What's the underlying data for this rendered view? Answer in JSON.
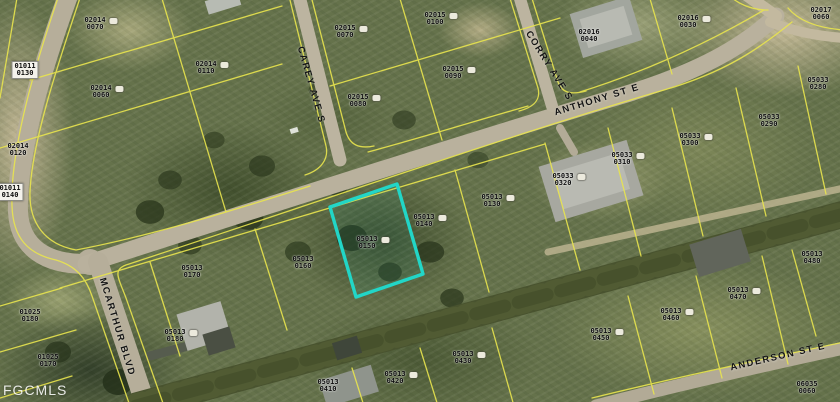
{
  "map": {
    "watermark": "FGCMLS",
    "highlighted_parcel": {
      "block": "05013",
      "lot": "0150",
      "outline_color": "#22d6c7"
    },
    "parcel_line_color": "#e9e54e",
    "streets": [
      {
        "name": "CAREY AVE S",
        "x": 311,
        "y": 85,
        "rotate": 74
      },
      {
        "name": "CORRY AVE S",
        "x": 549,
        "y": 66,
        "rotate": 58
      },
      {
        "name": "ANTHONY ST E",
        "x": 597,
        "y": 100,
        "rotate": -17
      },
      {
        "name": "MCARTHUR BLVD",
        "x": 117,
        "y": 327,
        "rotate": 73
      },
      {
        "name": "ANDERSON ST E",
        "x": 778,
        "y": 357,
        "rotate": -13
      }
    ],
    "parcels": [
      {
        "block": "02014",
        "lot": "0070",
        "x": 95,
        "y": 24,
        "chip": false,
        "icon": true,
        "highlighted": false
      },
      {
        "block": "01011",
        "lot": "0130",
        "x": 25,
        "y": 70,
        "chip": true,
        "icon": false,
        "highlighted": false
      },
      {
        "block": "02014",
        "lot": "0110",
        "x": 206,
        "y": 68,
        "chip": false,
        "icon": true,
        "highlighted": false
      },
      {
        "block": "02014",
        "lot": "0060",
        "x": 101,
        "y": 92,
        "chip": false,
        "icon": true,
        "highlighted": false
      },
      {
        "block": "02014",
        "lot": "0120",
        "x": 18,
        "y": 150,
        "chip": false,
        "icon": false,
        "highlighted": false
      },
      {
        "block": "01011",
        "lot": "0140",
        "x": 10,
        "y": 192,
        "chip": true,
        "icon": false,
        "highlighted": false
      },
      {
        "block": "02015",
        "lot": "0070",
        "x": 345,
        "y": 32,
        "chip": false,
        "icon": true,
        "highlighted": false
      },
      {
        "block": "02015",
        "lot": "0100",
        "x": 435,
        "y": 19,
        "chip": false,
        "icon": true,
        "highlighted": false
      },
      {
        "block": "02015",
        "lot": "0090",
        "x": 453,
        "y": 73,
        "chip": false,
        "icon": true,
        "highlighted": false
      },
      {
        "block": "02015",
        "lot": "0080",
        "x": 358,
        "y": 101,
        "chip": false,
        "icon": true,
        "highlighted": false
      },
      {
        "block": "02016",
        "lot": "0040",
        "x": 589,
        "y": 36,
        "chip": false,
        "icon": false,
        "highlighted": false
      },
      {
        "block": "02016",
        "lot": "0030",
        "x": 688,
        "y": 22,
        "chip": false,
        "icon": true,
        "highlighted": false
      },
      {
        "block": "02017",
        "lot": "0060",
        "x": 821,
        "y": 14,
        "chip": false,
        "icon": false,
        "highlighted": false
      },
      {
        "block": "05033",
        "lot": "0280",
        "x": 818,
        "y": 84,
        "chip": false,
        "icon": false,
        "highlighted": false
      },
      {
        "block": "05033",
        "lot": "0290",
        "x": 769,
        "y": 121,
        "chip": false,
        "icon": false,
        "highlighted": false
      },
      {
        "block": "05033",
        "lot": "0300",
        "x": 690,
        "y": 140,
        "chip": false,
        "icon": true,
        "highlighted": false
      },
      {
        "block": "05033",
        "lot": "0310",
        "x": 622,
        "y": 159,
        "chip": false,
        "icon": true,
        "highlighted": false
      },
      {
        "block": "05033",
        "lot": "0320",
        "x": 563,
        "y": 180,
        "chip": false,
        "icon": true,
        "highlighted": false
      },
      {
        "block": "05013",
        "lot": "0130",
        "x": 492,
        "y": 201,
        "chip": false,
        "icon": true,
        "highlighted": false
      },
      {
        "block": "05013",
        "lot": "0140",
        "x": 424,
        "y": 221,
        "chip": false,
        "icon": true,
        "highlighted": false
      },
      {
        "block": "05013",
        "lot": "0150",
        "x": 367,
        "y": 243,
        "chip": false,
        "icon": true,
        "highlighted": true
      },
      {
        "block": "05013",
        "lot": "0160",
        "x": 303,
        "y": 263,
        "chip": false,
        "icon": false,
        "highlighted": false
      },
      {
        "block": "05013",
        "lot": "0170",
        "x": 192,
        "y": 272,
        "chip": false,
        "icon": false,
        "highlighted": false
      },
      {
        "block": "01025",
        "lot": "0180",
        "x": 30,
        "y": 316,
        "chip": false,
        "icon": false,
        "highlighted": false
      },
      {
        "block": "01025",
        "lot": "0170",
        "x": 48,
        "y": 361,
        "chip": false,
        "icon": false,
        "highlighted": false
      },
      {
        "block": "05013",
        "lot": "0180",
        "x": 175,
        "y": 336,
        "chip": false,
        "icon": true,
        "highlighted": false
      },
      {
        "block": "05013",
        "lot": "0410",
        "x": 328,
        "y": 386,
        "chip": false,
        "icon": false,
        "highlighted": false
      },
      {
        "block": "05013",
        "lot": "0420",
        "x": 395,
        "y": 378,
        "chip": false,
        "icon": true,
        "highlighted": false
      },
      {
        "block": "05013",
        "lot": "0430",
        "x": 463,
        "y": 358,
        "chip": false,
        "icon": true,
        "highlighted": false
      },
      {
        "block": "05013",
        "lot": "0450",
        "x": 601,
        "y": 335,
        "chip": false,
        "icon": true,
        "highlighted": false
      },
      {
        "block": "05013",
        "lot": "0460",
        "x": 671,
        "y": 315,
        "chip": false,
        "icon": true,
        "highlighted": false
      },
      {
        "block": "05013",
        "lot": "0470",
        "x": 738,
        "y": 294,
        "chip": false,
        "icon": true,
        "highlighted": false
      },
      {
        "block": "05013",
        "lot": "0480",
        "x": 812,
        "y": 258,
        "chip": false,
        "icon": false,
        "highlighted": false
      },
      {
        "block": "06035",
        "lot": "0060",
        "x": 807,
        "y": 388,
        "chip": false,
        "icon": false,
        "highlighted": false
      }
    ]
  }
}
